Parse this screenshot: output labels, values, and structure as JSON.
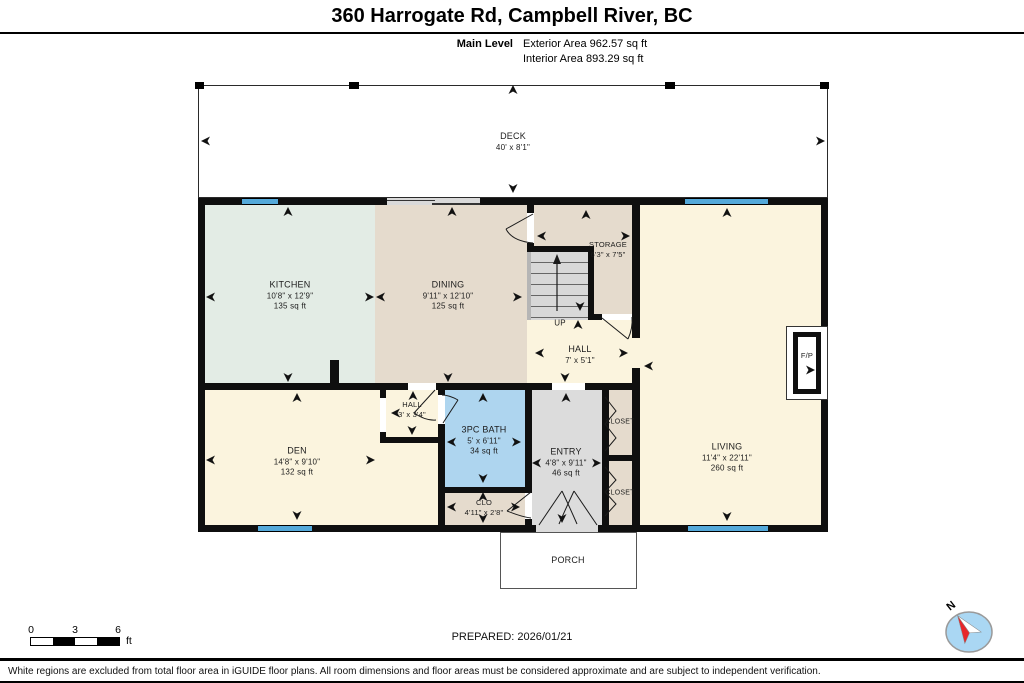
{
  "header": {
    "title": "360 Harrogate Rd, Campbell River, BC",
    "level": "Main Level",
    "exterior": "Exterior Area 962.57 sq ft",
    "interior": "Interior Area 893.29 sq ft"
  },
  "rooms": {
    "deck": {
      "name": "DECK",
      "dims": "40' x 8'1\""
    },
    "kitchen": {
      "name": "KITCHEN",
      "dims": "10'8\" x 12'9\"",
      "area": "135 sq ft"
    },
    "dining": {
      "name": "DINING",
      "dims": "9'11\" x 12'10\"",
      "area": "125 sq ft"
    },
    "storage": {
      "name": "STORAGE",
      "dims": "6'3\" x 7'5\""
    },
    "stairs": {
      "label": "UP"
    },
    "hall": {
      "name": "HALL",
      "dims": "7' x 5'1\""
    },
    "living": {
      "name": "LIVING",
      "dims": "11'4\" x 22'11\"",
      "area": "260 sq ft"
    },
    "fireplace": {
      "name": "F/P"
    },
    "den": {
      "name": "DEN",
      "dims": "14'8\" x 9'10\"",
      "area": "132 sq ft"
    },
    "hall_small": {
      "name": "HALL",
      "dims": "3' x 3'4\""
    },
    "bath": {
      "name": "3PC BATH",
      "dims": "5' x 6'11\"",
      "area": "34 sq ft"
    },
    "entry": {
      "name": "ENTRY",
      "dims": "4'8\" x 9'11\"",
      "area": "46 sq ft"
    },
    "closet_upper": {
      "name": "CLOSET"
    },
    "closet_lower": {
      "name": "CLOSET"
    },
    "clo": {
      "name": "CLO",
      "dims": "4'11\" x 2'8\""
    },
    "porch": {
      "name": "PORCH"
    }
  },
  "scale_bar": {
    "labels": [
      "0",
      "3",
      "6"
    ],
    "unit": "ft"
  },
  "compass": {
    "label": "N"
  },
  "footer": {
    "prepared": "PREPARED: 2026/01/21",
    "disclaimer": "White regions are excluded from total floor area in iGUIDE floor plans. All room dimensions and floor areas must be considered approximate and are subject to independent verification."
  },
  "colors": {
    "wall": "#0f0f0f",
    "window": "#54a9da",
    "kitchen": "#e3ece5",
    "tan": "#e5dbcd",
    "cream": "#fbf4de",
    "bath": "#aed5ef",
    "entry_grey": "#dcdcdc",
    "stairs_grey": "#d8d8d8",
    "compass_blue": "#aad7f3",
    "compass_red": "#e8262a"
  }
}
